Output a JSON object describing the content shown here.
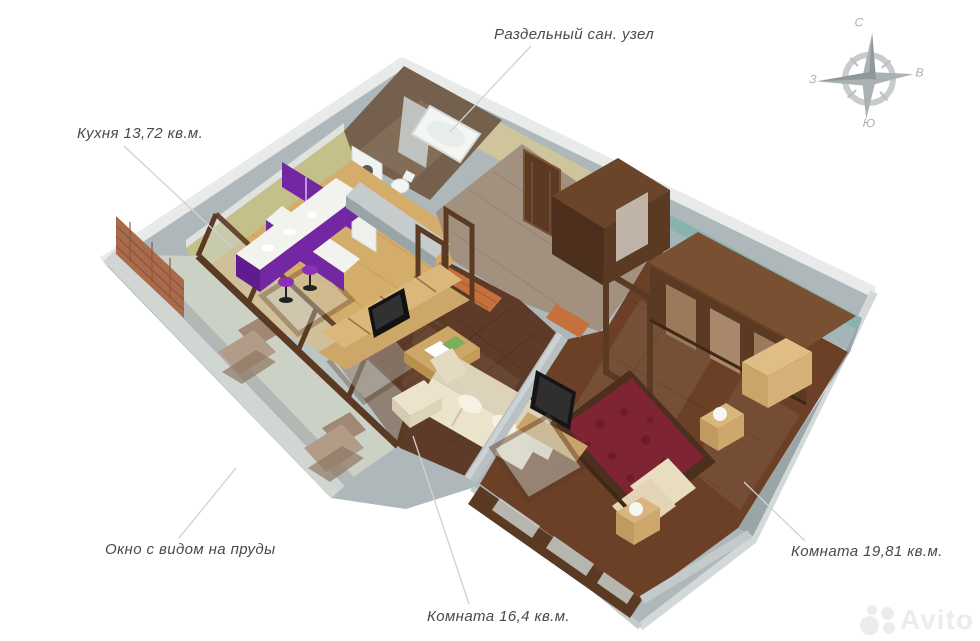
{
  "scene": {
    "background": "#ffffff",
    "description": "3D floor plan render of apartment"
  },
  "labels": {
    "san_uzel": "Раздельный сан. узел",
    "kitchen": "Кухня 13,72 кв.м.",
    "window_view": "Окно с видом на пруды",
    "room_16": "Комната 16,4 кв.м.",
    "room_19": "Комната 19,81 кв.м."
  },
  "compass": {
    "n": "С",
    "e": "В",
    "s": "Ю",
    "w": "З"
  },
  "watermark": "Avito",
  "colors": {
    "silhouette": "#aeb7b9",
    "wall_top": "#c6cbcc",
    "wall_face": "#9aa5a8",
    "rim": "#e8ebea",
    "kitchen_wall": "#c3c08a",
    "kitchen_floor": "#d4ad6a",
    "cabinet_purple": "#7427a3",
    "cabinet_purple_dark": "#5e1c8e",
    "bath_wall": "#74604d",
    "fixture_white": "#f4f6f3",
    "hall_wall": "#cfc59c",
    "hall_floor": "#a3917f",
    "accent_brick": "#c4713e",
    "bedroom_wall": "#a2b5b9",
    "bedroom_border": "#86b3ae",
    "bedroom_floor": "#6b4026",
    "living_floor": "#5e3b28",
    "wood_dark": "#5b3a24",
    "wood_mid": "#7a5033",
    "wood_light": "#cda768",
    "sofa_cream": "#ece3cd",
    "bed_red": "#7e2433",
    "balcony_floor": "#ccd1c6",
    "brick": "#a96b4b",
    "label_text": "#4a4a4a",
    "leader": "#cfd3cf",
    "compass_gray": "#b0b6b8",
    "watermark_gray": "#ececec"
  }
}
